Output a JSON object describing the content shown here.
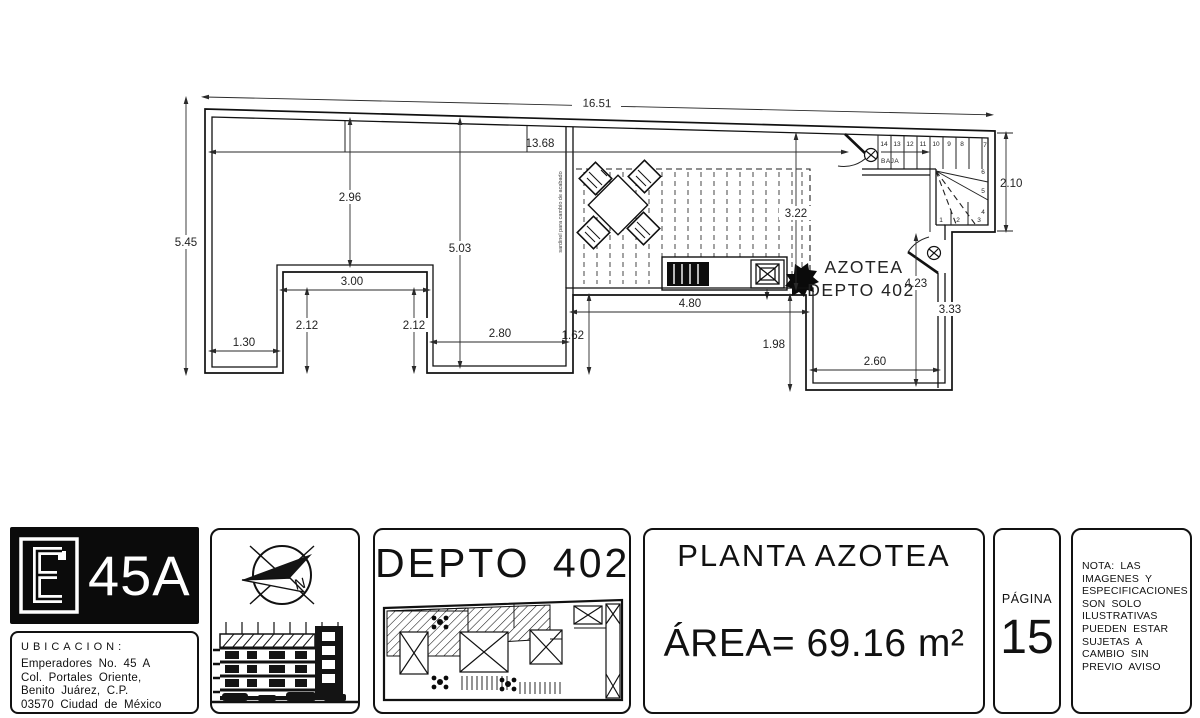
{
  "plan": {
    "dims": {
      "total": "16.51",
      "interior": "13.68",
      "left_height": "5.45",
      "v296": "2.96",
      "v503": "5.03",
      "h300": "3.00",
      "v212l": "2.12",
      "v212r": "2.12",
      "h130": "1.30",
      "h280": "2.80",
      "v162": "1.62",
      "h480": "4.80",
      "v198": "1.98",
      "v322": "3.22",
      "v423": "4.23",
      "v333": "3.33",
      "h260": "2.60",
      "v210": "2.10"
    },
    "labels": {
      "room_line1": "AZOTEA",
      "room_line2": "DEPTO 402",
      "curb_note": "sardinel para cambio de acabado"
    },
    "stairs": {
      "baja": "BAJA",
      "numbers": [
        "14",
        "13",
        "12",
        "11",
        "10",
        "9",
        "8",
        "7",
        "6",
        "5",
        "4",
        "3",
        "2",
        "1"
      ]
    }
  },
  "titleblock": {
    "logo": {
      "name": "45A"
    },
    "ubicacion": {
      "heading": "UBICACION:",
      "lines": [
        "Emperadores No. 45 A",
        "Col. Portales Oriente,",
        "Benito Juárez, C.P.",
        "03570 Ciudad de México"
      ]
    },
    "unit": {
      "title": "DEPTO 402"
    },
    "sheet": {
      "title": "PLANTA AZOTEA",
      "area": "ÁREA= 69.16 m²"
    },
    "page": {
      "label": "PÁGINA",
      "number": "15"
    },
    "nota": {
      "lines": [
        "NOTA: LAS",
        "IMAGENES Y",
        "ESPECIFICACIONES",
        "SON SOLO",
        "ILUSTRATIVAS",
        "PUEDEN ESTAR",
        "SUJETAS A",
        "CAMBIO SIN",
        "PREVIO AVISO"
      ]
    }
  }
}
